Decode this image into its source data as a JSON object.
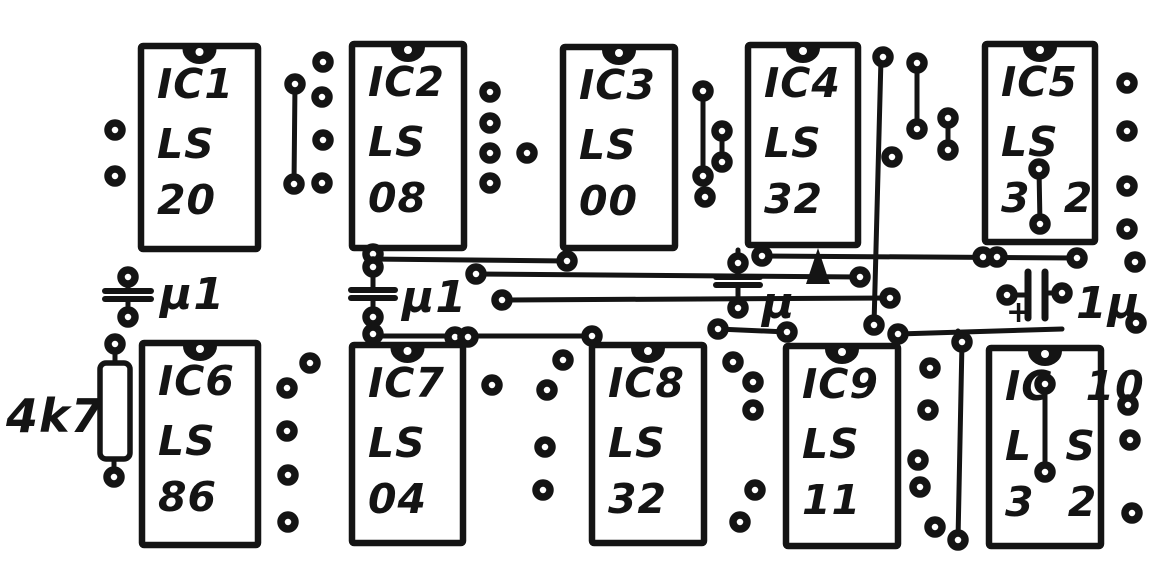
{
  "drawing": {
    "kind": "hand-drawn PCB component layout",
    "ink": "#141414",
    "paper": "#ffffff"
  },
  "ics": [
    {
      "name": "IC1",
      "lines": [
        "IC1",
        "LS",
        "20"
      ],
      "x": 141,
      "y": 46,
      "w": 117,
      "h": 203
    },
    {
      "name": "IC2",
      "lines": [
        "IC2",
        "LS",
        "08"
      ],
      "x": 352,
      "y": 44,
      "w": 112,
      "h": 204
    },
    {
      "name": "IC3",
      "lines": [
        "IC3",
        "LS",
        "00"
      ],
      "x": 563,
      "y": 47,
      "w": 112,
      "h": 201
    },
    {
      "name": "IC4",
      "lines": [
        "IC4",
        "LS",
        "32"
      ],
      "x": 748,
      "y": 45,
      "w": 110,
      "h": 200
    },
    {
      "name": "IC5",
      "lines": [
        "IC5",
        "LS",
        "3 2"
      ],
      "x": 985,
      "y": 44,
      "w": 110,
      "h": 198
    },
    {
      "name": "IC6",
      "lines": [
        "IC6",
        "LS",
        "86"
      ],
      "x": 142,
      "y": 343,
      "w": 116,
      "h": 202
    },
    {
      "name": "IC7",
      "lines": [
        "IC7",
        "LS",
        "04"
      ],
      "x": 352,
      "y": 345,
      "w": 111,
      "h": 198
    },
    {
      "name": "IC8",
      "lines": [
        "IC8",
        "LS",
        "32"
      ],
      "x": 592,
      "y": 345,
      "w": 112,
      "h": 198
    },
    {
      "name": "IC9",
      "lines": [
        "IC9",
        "LS",
        "11"
      ],
      "x": 786,
      "y": 346,
      "w": 112,
      "h": 200
    },
    {
      "name": "IC10",
      "lines": [
        "IC 10",
        "L S",
        "3 2"
      ],
      "x": 989,
      "y": 348,
      "w": 112,
      "h": 198
    }
  ],
  "resistor": {
    "label": "4k7",
    "x": 100,
    "y": 363,
    "w": 30,
    "h": 96,
    "pad_top": [
      115,
      344
    ],
    "pad_bottom": [
      114,
      477
    ],
    "label_x": 6,
    "label_y": 432
  },
  "capacitors": [
    {
      "type": "ceramic",
      "label": "μ1",
      "cx": 128,
      "plate_y": 291,
      "plate_w": 46,
      "stem_top": 277,
      "stem_bottom": 317,
      "label_x": 160,
      "label_y": 309
    },
    {
      "type": "ceramic",
      "label": "μ1",
      "cx": 373,
      "plate_y": 290,
      "plate_w": 44,
      "stem_top": 250,
      "stem_bottom": 345,
      "label_x": 402,
      "label_y": 312
    },
    {
      "type": "ceramic",
      "label": "μ",
      "cx": 738,
      "plate_y": 277,
      "plate_w": 44,
      "stem_top": 250,
      "stem_bottom": 308,
      "label_x": 762,
      "label_y": 318,
      "arrow": {
        "x": 818,
        "tip_y": 248,
        "base_y": 284,
        "half_w": 12
      }
    },
    {
      "type": "electrolytic",
      "label": "1μ",
      "cy": 294,
      "lead_left_x": 1007,
      "lead_right_x": 1062,
      "bars_x": [
        1028,
        1045
      ],
      "bar_top": 272,
      "bar_bottom": 318,
      "plus": {
        "mark": "+",
        "x": 1006,
        "y": 322
      },
      "label_x": 1076,
      "label_y": 318
    }
  ],
  "traces": [
    [
      373,
      259,
      567,
      261
    ],
    [
      476,
      274,
      860,
      277
    ],
    [
      502,
      300,
      890,
      298
    ],
    [
      373,
      336,
      592,
      336
    ],
    [
      762,
      256,
      1077,
      258
    ],
    [
      718,
      329,
      787,
      332
    ],
    [
      898,
      334,
      1062,
      329
    ],
    [
      881,
      58,
      874,
      325
    ],
    [
      962,
      342,
      958,
      540
    ],
    [
      958,
      342,
      958,
      331
    ],
    [
      295,
      84,
      294,
      184
    ],
    [
      703,
      91,
      703,
      177
    ],
    [
      722,
      131,
      722,
      162
    ],
    [
      917,
      63,
      917,
      129
    ],
    [
      948,
      118,
      948,
      150
    ],
    [
      1039,
      169,
      1040,
      224
    ],
    [
      1045,
      384,
      1045,
      472
    ]
  ],
  "pads": [
    [
      115,
      130
    ],
    [
      115,
      176
    ],
    [
      295,
      84
    ],
    [
      294,
      184
    ],
    [
      323,
      62
    ],
    [
      322,
      97
    ],
    [
      323,
      140
    ],
    [
      322,
      183
    ],
    [
      490,
      92
    ],
    [
      490,
      123
    ],
    [
      490,
      153
    ],
    [
      490,
      183
    ],
    [
      527,
      153
    ],
    [
      703,
      91
    ],
    [
      703,
      176
    ],
    [
      705,
      197
    ],
    [
      722,
      131
    ],
    [
      722,
      162
    ],
    [
      567,
      261
    ],
    [
      883,
      57
    ],
    [
      874,
      325
    ],
    [
      892,
      157
    ],
    [
      917,
      63
    ],
    [
      917,
      129
    ],
    [
      948,
      118
    ],
    [
      948,
      150
    ],
    [
      1039,
      169
    ],
    [
      1040,
      224
    ],
    [
      1127,
      83
    ],
    [
      1127,
      131
    ],
    [
      1127,
      186
    ],
    [
      1127,
      229
    ],
    [
      1135,
      262
    ],
    [
      1136,
      323
    ],
    [
      128,
      277
    ],
    [
      128,
      317
    ],
    [
      373,
      254
    ],
    [
      373,
      267
    ],
    [
      373,
      317
    ],
    [
      373,
      334
    ],
    [
      476,
      274
    ],
    [
      860,
      277
    ],
    [
      502,
      300
    ],
    [
      890,
      298
    ],
    [
      455,
      337
    ],
    [
      468,
      337
    ],
    [
      592,
      336
    ],
    [
      762,
      256
    ],
    [
      738,
      263
    ],
    [
      738,
      308
    ],
    [
      983,
      257
    ],
    [
      997,
      257
    ],
    [
      1077,
      258
    ],
    [
      718,
      329
    ],
    [
      787,
      332
    ],
    [
      898,
      334
    ],
    [
      962,
      342
    ],
    [
      958,
      540
    ],
    [
      1007,
      295
    ],
    [
      1062,
      293
    ],
    [
      1045,
      384
    ],
    [
      1045,
      472
    ],
    [
      115,
      344
    ],
    [
      114,
      477
    ],
    [
      310,
      363
    ],
    [
      287,
      388
    ],
    [
      287,
      431
    ],
    [
      288,
      475
    ],
    [
      288,
      522
    ],
    [
      492,
      385
    ],
    [
      563,
      360
    ],
    [
      547,
      390
    ],
    [
      545,
      447
    ],
    [
      543,
      490
    ],
    [
      733,
      362
    ],
    [
      753,
      382
    ],
    [
      753,
      410
    ],
    [
      755,
      490
    ],
    [
      740,
      522
    ],
    [
      930,
      368
    ],
    [
      928,
      410
    ],
    [
      918,
      460
    ],
    [
      920,
      487
    ],
    [
      935,
      527
    ],
    [
      1128,
      405
    ],
    [
      1130,
      440
    ],
    [
      1132,
      513
    ]
  ]
}
